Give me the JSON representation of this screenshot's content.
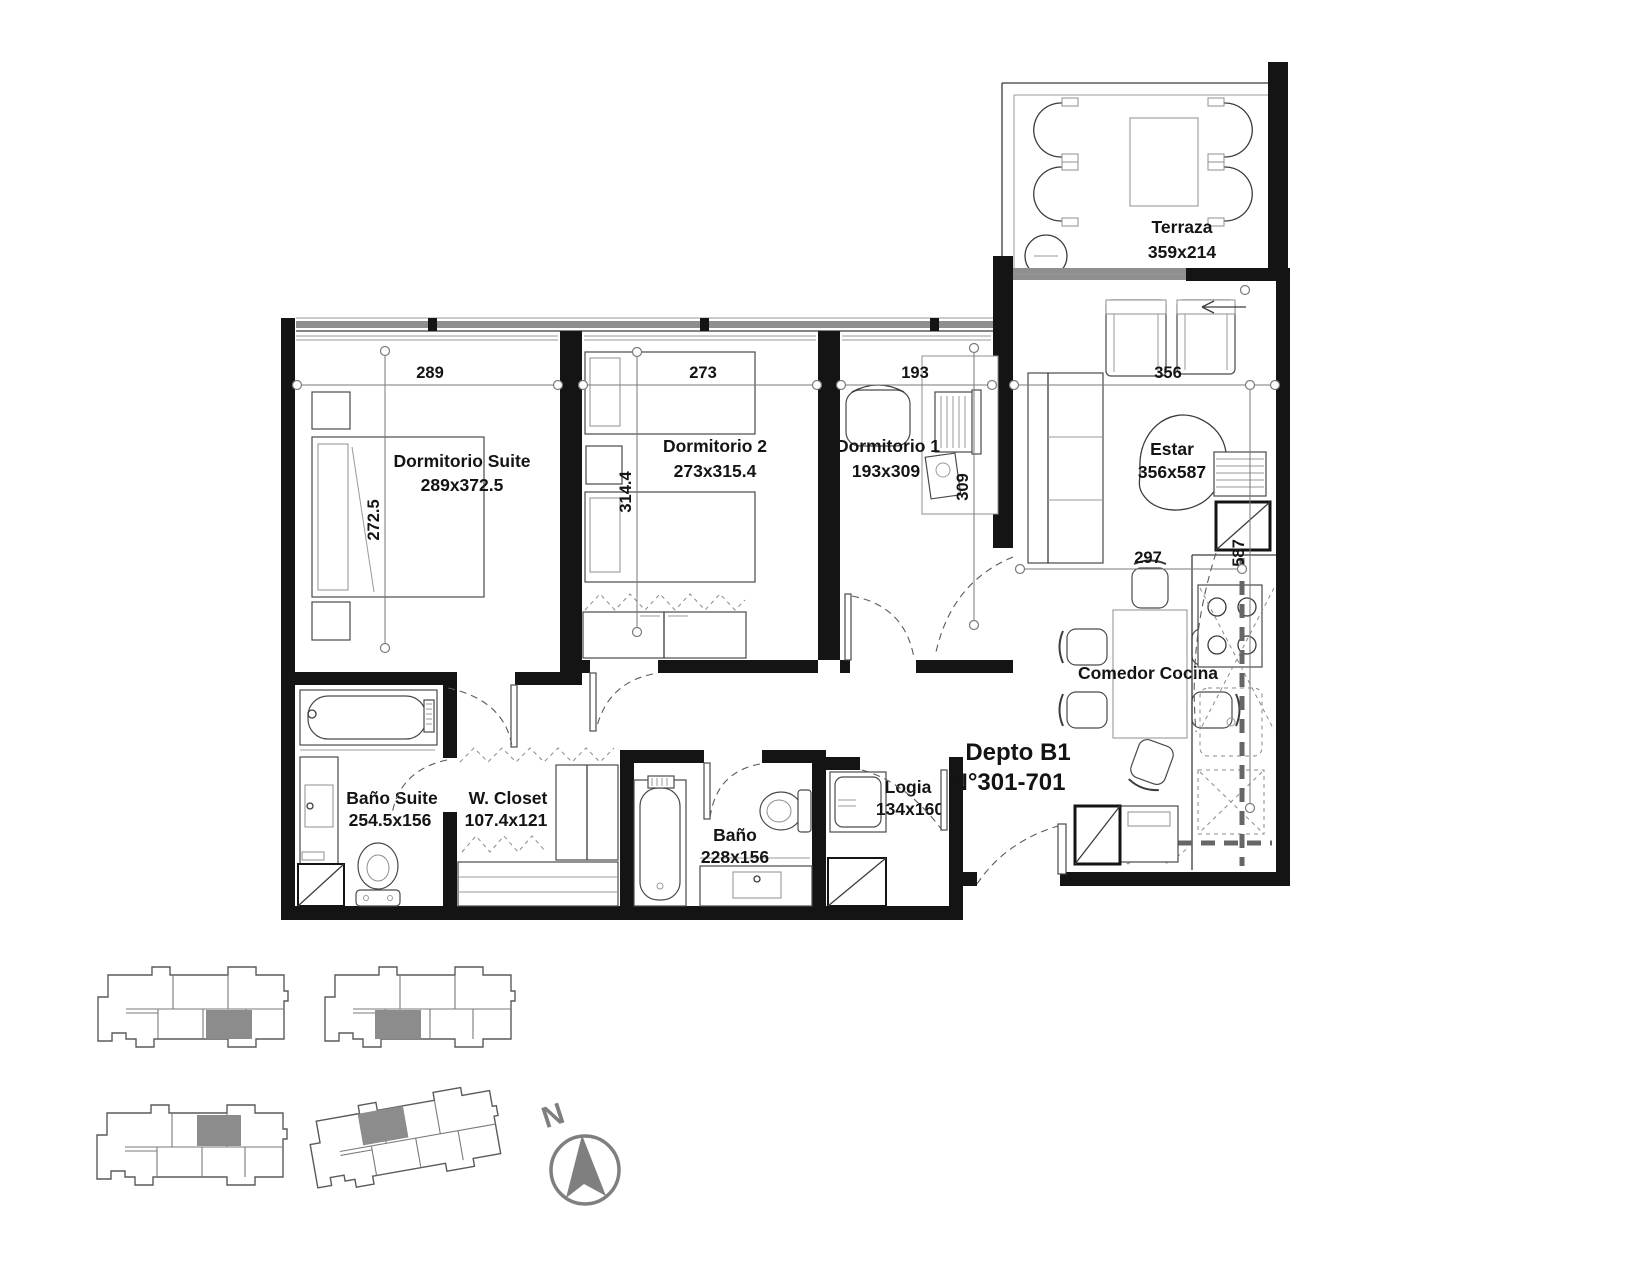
{
  "plan": {
    "unit": {
      "name": "Depto B1",
      "range": "N°301-701"
    },
    "rooms": [
      {
        "name": "Terraza",
        "dims": "359x214"
      },
      {
        "name": "Dormitorio Suite",
        "dims": "289x372.5"
      },
      {
        "name": "Dormitorio 2",
        "dims": "273x315.4"
      },
      {
        "name": "Dormitorio 1",
        "dims": "193x309"
      },
      {
        "name": "Estar",
        "dims": "356x587"
      },
      {
        "name": "Comedor Cocina",
        "dims": ""
      },
      {
        "name": "Baño Suite",
        "dims": "254.5x156"
      },
      {
        "name": "W. Closet",
        "dims": "107.4x121"
      },
      {
        "name": "Baño",
        "dims": "228x156"
      },
      {
        "name": "Logia",
        "dims": "134x160"
      }
    ],
    "dimensions": {
      "suite_width": "289",
      "dorm2_width": "273",
      "dorm1_width": "193",
      "estar_width": "356",
      "suite_depth": "272.5",
      "dorm2_depth": "314.4",
      "dorm1_depth": "309",
      "comedor_width": "297",
      "estar_depth": "587"
    },
    "compass": {
      "north": "N"
    },
    "colors": {
      "wall": "#141414",
      "line": "#3c3c3c",
      "light_line": "#9a9a9a",
      "window_band": "#8f8f8f",
      "unit_highlight": "#8c8c8c",
      "compass": "#7f7f7f"
    }
  }
}
